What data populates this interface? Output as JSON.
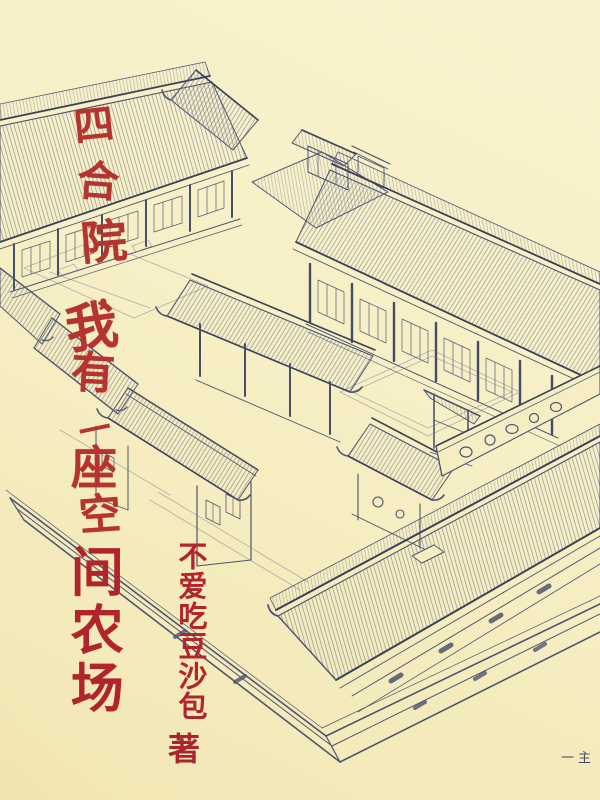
{
  "cover": {
    "title_full": "四合院，我有一座空间农场",
    "title_script_part": "四合院，我有一座空",
    "title_print_part": "间农场",
    "author_name": "不爱吃豆沙包",
    "author_suffix": "著",
    "corner_mark": "一主",
    "illustration_subject": "siheyuan-courtyard-line-drawing",
    "colors": {
      "background": "#f7efc5",
      "ink": "#4d5570",
      "title_red": "#b2242c",
      "script_red": "#b5342e"
    }
  }
}
